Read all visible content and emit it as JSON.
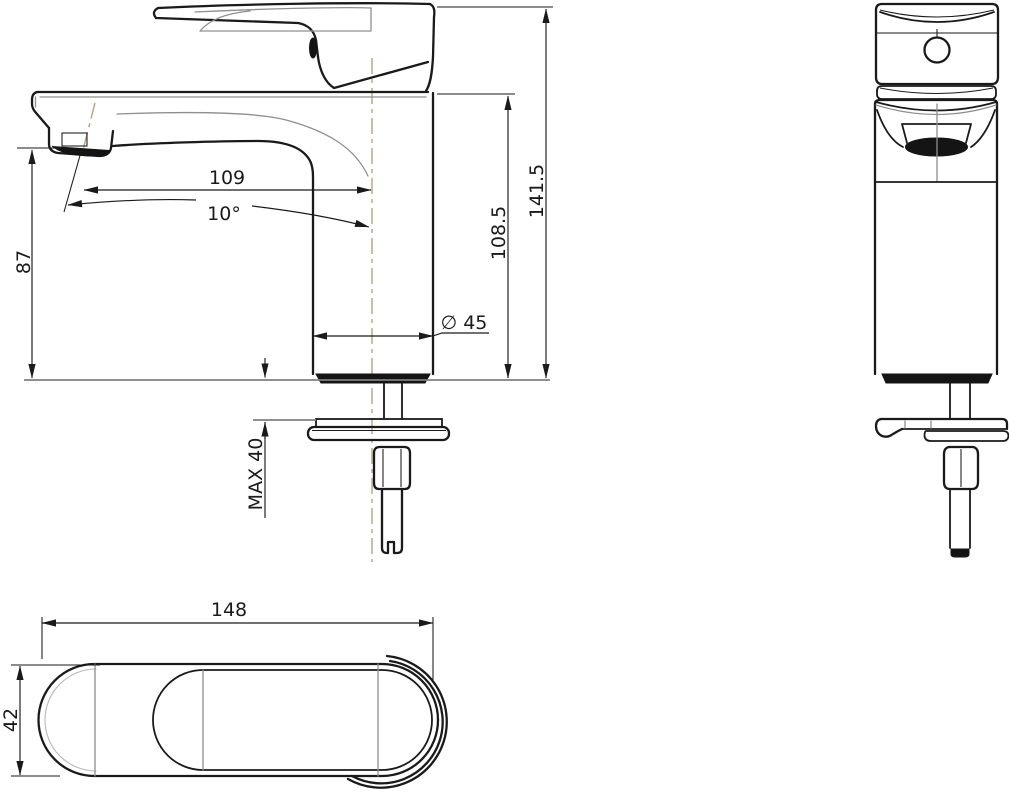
{
  "colors": {
    "ink": "#1a1a1a",
    "sec": "#8f8f8f",
    "lt": "#b8b8b8",
    "base": "#7f7f7f",
    "center": "#b3a27e",
    "dark": "#141414",
    "bg": "#ffffff"
  },
  "dims": {
    "reach": "109",
    "angle": "10°",
    "spout_height": "87",
    "body_height": "108.5",
    "total_height": "141.5",
    "diameter": "∅ 45",
    "max_deck": "MAX 40",
    "handle_length": "148",
    "handle_width": "42"
  }
}
